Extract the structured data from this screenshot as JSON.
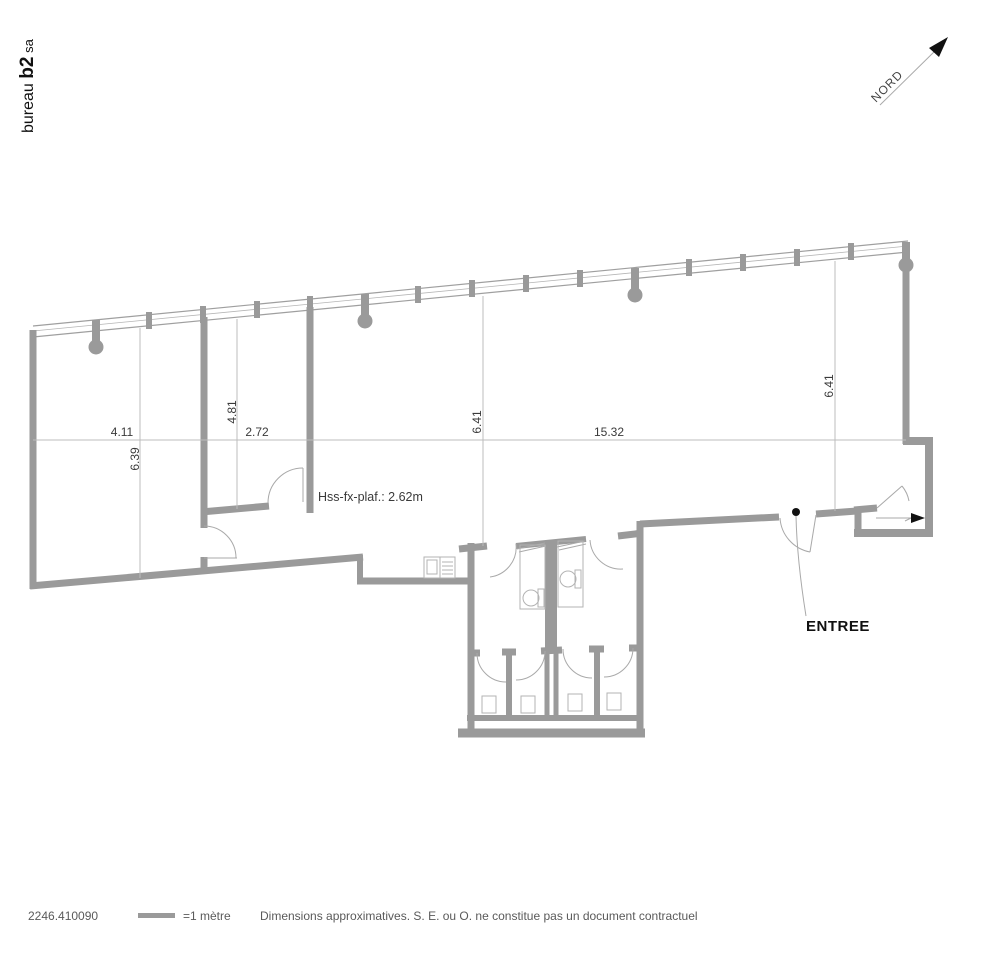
{
  "branding": {
    "logo_word1": "bureau ",
    "logo_word2": "b2",
    "logo_word3": " sa"
  },
  "north": {
    "label": "NORD"
  },
  "plan": {
    "ceiling_note": "Hss-fx-plaf.: 2.62m",
    "entrance_label": "ENTREE",
    "dims_h": [
      "4.11",
      "2.72",
      "15.32"
    ],
    "dims_v": [
      "6.39",
      "4.81",
      "6.41",
      "6.41"
    ]
  },
  "footer": {
    "reference": "2246.410090",
    "scale_label": "=1 mètre",
    "disclaimer": "Dimensions approximatives. S. E. ou O. ne constitue pas un document contractuel"
  },
  "colors": {
    "wall_gray": "#9a9a9a",
    "thin_line": "#a9a9a9",
    "dimension_line": "#bcbcbc",
    "text_dark": "#3a3a3a",
    "black": "#111111",
    "footer_text": "#5a5a5a"
  }
}
